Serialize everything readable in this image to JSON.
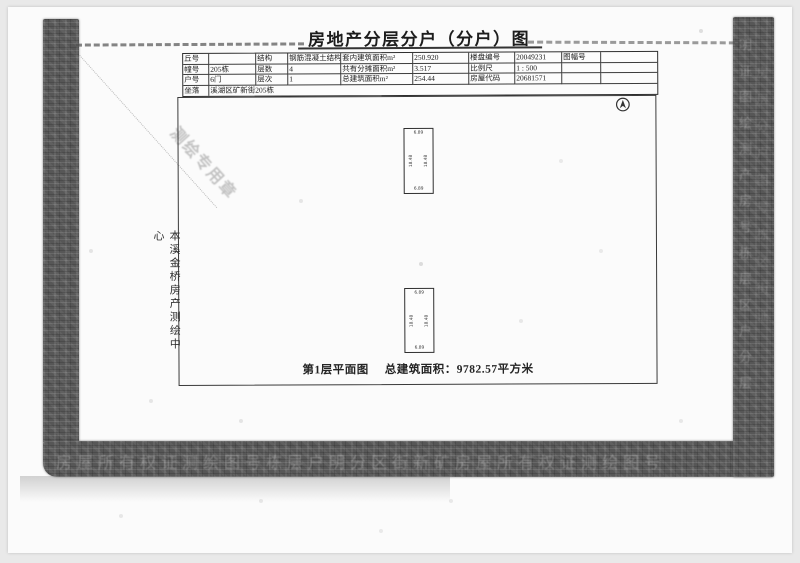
{
  "scan": {
    "title": "房地产分层分户（分户）图",
    "table": {
      "rows": [
        {
          "c1l": "丘号",
          "c1v": "",
          "c2l": "结构",
          "c2v": "钢筋混凝土结构",
          "c3l": "套内建筑面积m²",
          "c3v": "250.920",
          "c4l": "楼盘编号",
          "c4v": "20049231",
          "c5l": "图幅号",
          "c5v": ""
        },
        {
          "c1l": "幢号",
          "c1v": "205栋",
          "c2l": "层数",
          "c2v": "4",
          "c3l": "共有分摊面积m²",
          "c3v": "3.517",
          "c4l": "比例尺",
          "c4v": "1 : 500",
          "c5l": "",
          "c5v": ""
        },
        {
          "c1l": "户号",
          "c1v": "6门",
          "c2l": "层次",
          "c2v": "1",
          "c3l": "总建筑面积m²",
          "c3v": "254.44",
          "c4l": "房屋代码",
          "c4v": "20681571",
          "c5l": "",
          "c5v": ""
        }
      ],
      "address_label": "坐落",
      "address_value": "溪湖区矿新街205栋"
    },
    "plan": {
      "caption_title": "第1层平面图",
      "caption_area": "总建筑面积：9782.57平方米",
      "unit_top_dim": "6.89",
      "unit_bottom_dim": "6.89",
      "unit_side_dim": "18.48"
    },
    "agency": "本溪金桥房产测绘中心",
    "stamp_ghost": "测绘专用章",
    "ghosts": {
      "right_column": "明证图绘测产房号栋层区户分层",
      "right_column_2": "房层分户图号栋区街证",
      "bottom_row": "房屋所有权证测绘图号栋层户明分区街新矿房屋所有权证测绘图号"
    },
    "colors": {
      "band": "#575757",
      "paper": "#fbfbfb",
      "ink": "#222222",
      "background": "#e9e9e9"
    }
  }
}
